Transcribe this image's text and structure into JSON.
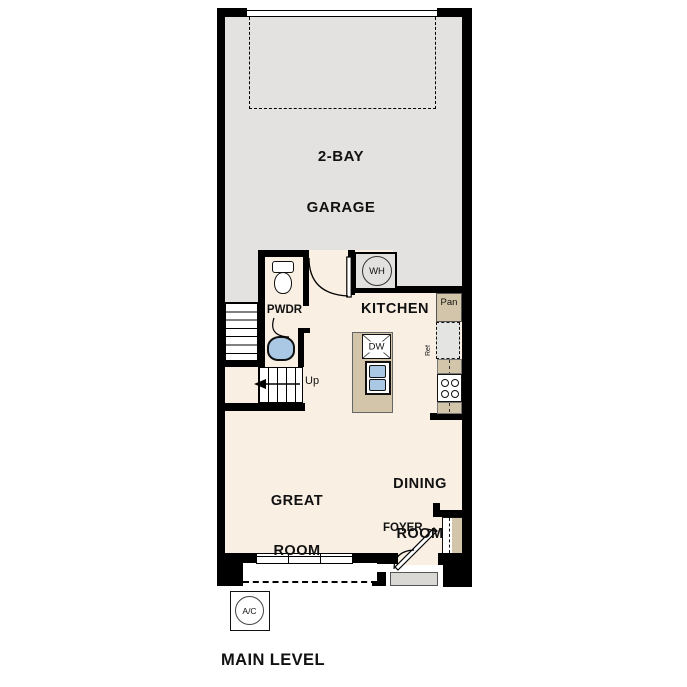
{
  "plan": {
    "title": "MAIN LEVEL",
    "rooms": {
      "garage_line1": "2-BAY",
      "garage_line2": "GARAGE",
      "kitchen": "KITCHEN",
      "powder": "PWDR",
      "great_line1": "GREAT",
      "great_line2": "ROOM",
      "dining_line1": "DINING",
      "dining_line2": "ROOM",
      "foyer": "FOYER"
    },
    "fixtures": {
      "water_heater": "WH",
      "pantry": "Pan",
      "refrigerator": "Ref",
      "dishwasher": "DW",
      "stair_direction": "Up",
      "ac": "A/C"
    },
    "colors": {
      "floor": "#f9efe3",
      "garage_floor": "#e3e2e0",
      "counter": "#d3c5a9",
      "sink_blue": "#aac8e4",
      "stoop": "#dad8d5",
      "wall": "#000000"
    }
  }
}
